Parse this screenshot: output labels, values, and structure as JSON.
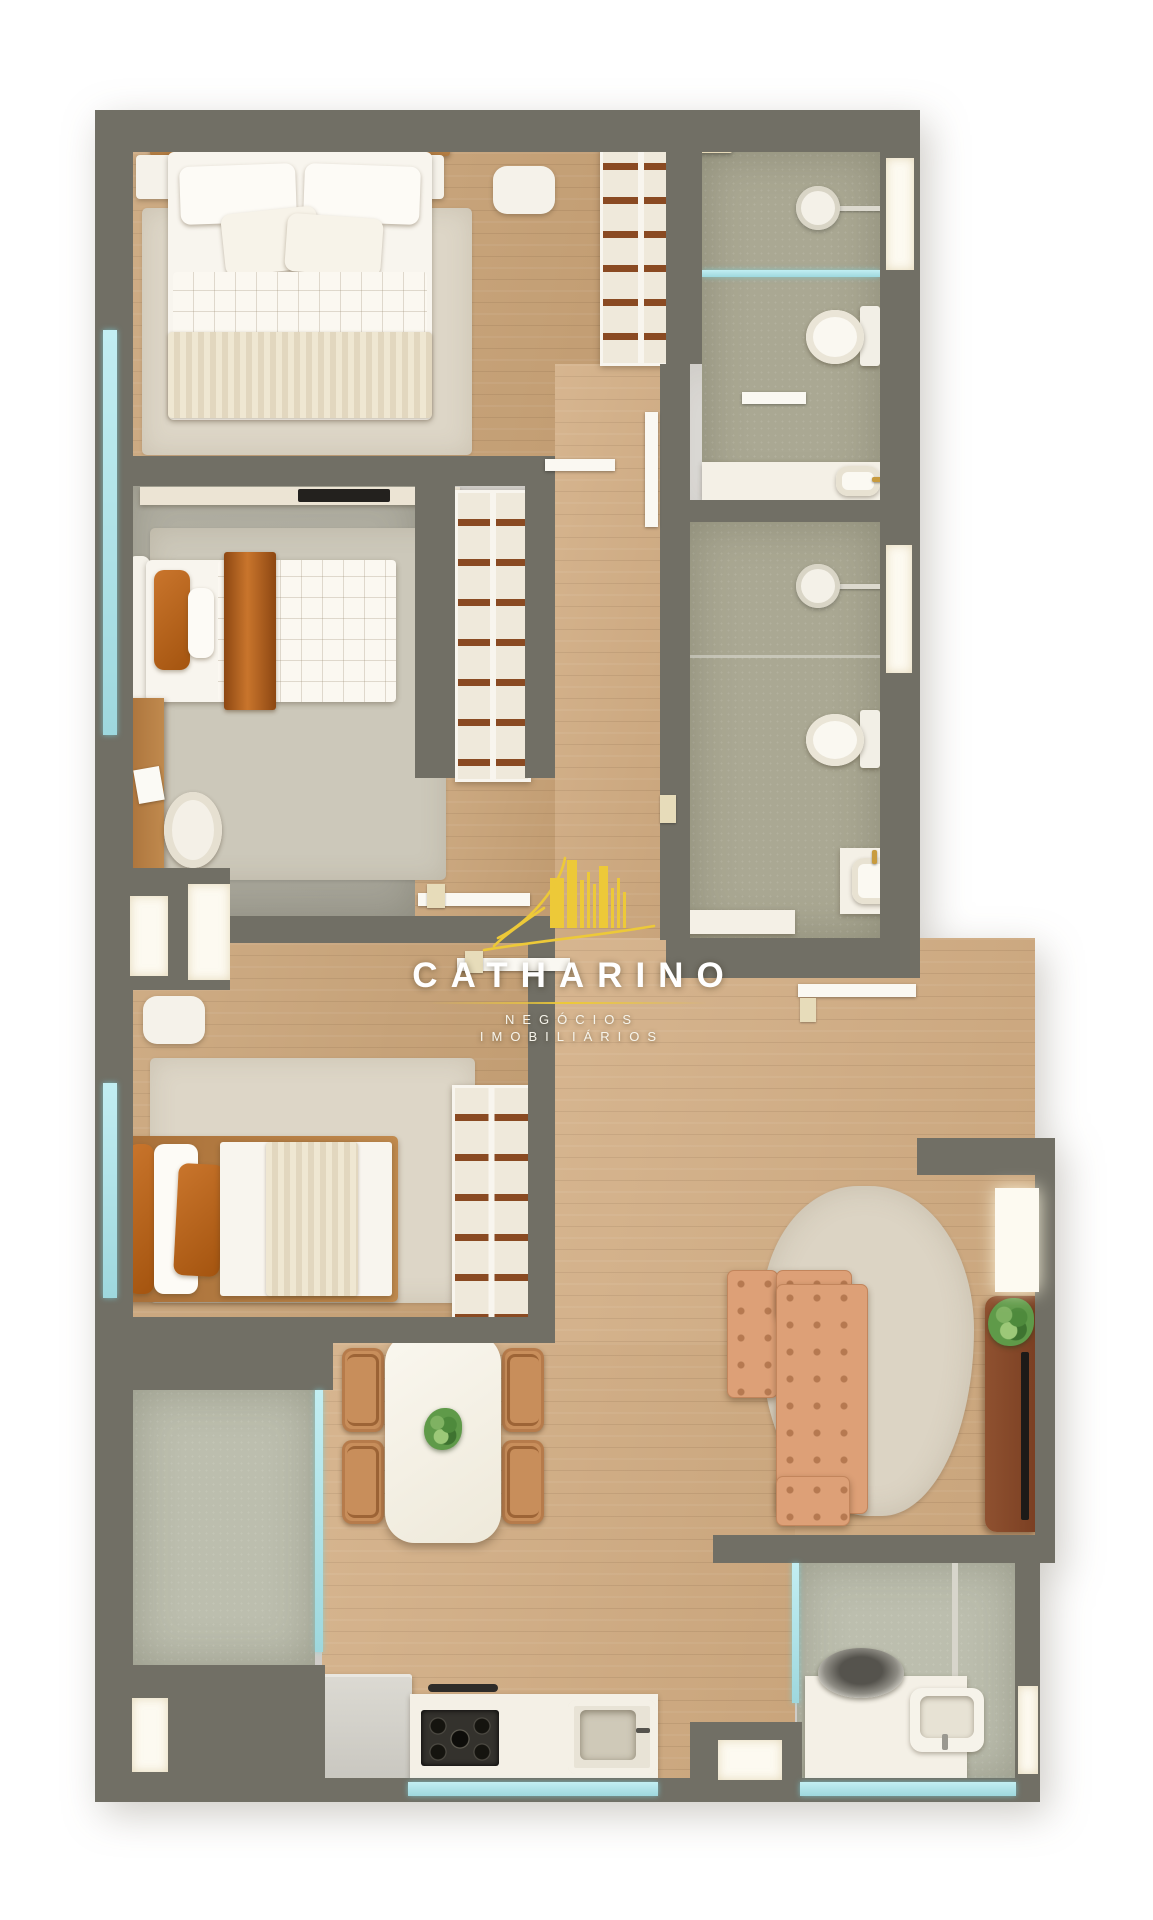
{
  "watermark": {
    "name": "CATHARINO",
    "subtitle_line1": "NEGÓCIOS",
    "subtitle_line2": "IMOBILIÁRIOS",
    "icon": "golden-buildings-skyline-icon"
  },
  "palette": {
    "background": "#FFFFFF",
    "wall": "#716F65",
    "wood_floor": "#C9A377",
    "bathroom_tile": "#AAA893",
    "service_tile": "#BCBEAE",
    "rug": "#DDD6C7",
    "sofa_leather": "#DDA077",
    "accent_caramel": "#B2601C",
    "tv_console": "#84492A",
    "glass": "#AEE4EA",
    "logo_gold": "#EDC938",
    "logo_text": "#FFFFFF"
  }
}
